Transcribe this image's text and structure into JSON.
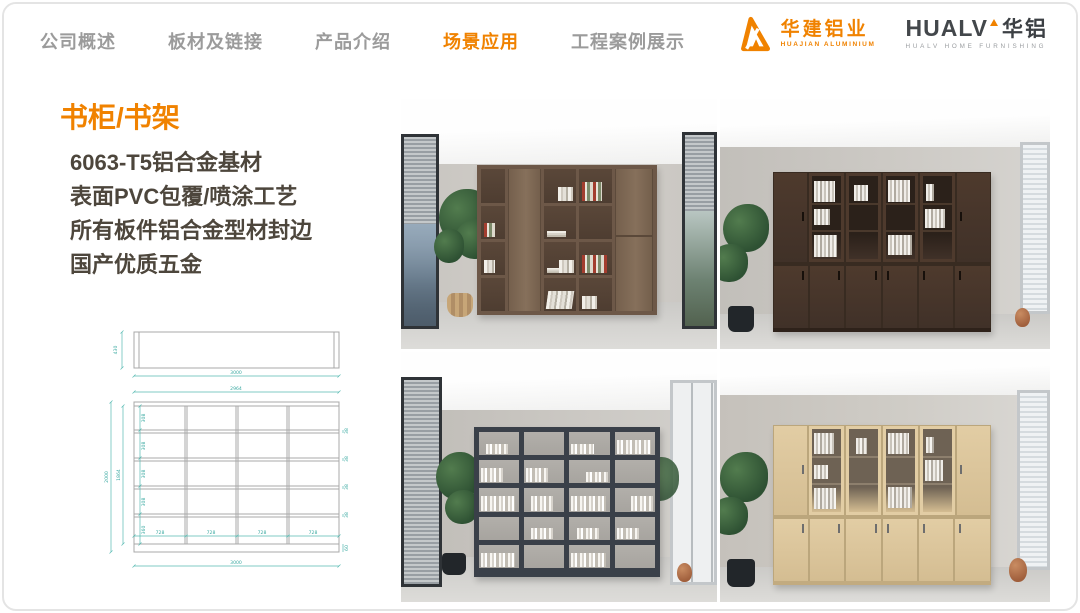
{
  "nav": {
    "items": [
      {
        "label": "公司概述",
        "active": false
      },
      {
        "label": "板材及链接",
        "active": false
      },
      {
        "label": "产品介绍",
        "active": false
      },
      {
        "label": "场景应用",
        "active": true
      },
      {
        "label": "工程案例展示",
        "active": false
      }
    ]
  },
  "brand": {
    "huajian_cn": "华建铝业",
    "huajian_en": "HUAJIAN ALUMINIUM",
    "hualv_en": "HUALV",
    "hualv_cn": "华铝",
    "hualv_sub": "HUALV HOME FURNISHING"
  },
  "content": {
    "title": "书柜/书架",
    "specs": [
      "6063-T5铝合金基材",
      "表面PVC包覆/喷涂工艺",
      "所有板件铝合金型材封边",
      "国产优质五金"
    ]
  },
  "drawing": {
    "top_view": {
      "height": "430",
      "width": "3000"
    },
    "front_view": {
      "inner_width": "2964",
      "total_width": "3000",
      "total_height": "2000",
      "inner_height": "1864",
      "rows": [
        "308",
        "308",
        "308",
        "308",
        "360"
      ],
      "cols": [
        "728",
        "728",
        "728",
        "728"
      ],
      "side": [
        "38",
        "38",
        "38",
        "38"
      ],
      "base": "60"
    }
  },
  "colors": {
    "accent": "#f08200",
    "nav_inactive": "#9b9b9b",
    "body_text": "#4d463c",
    "dim_line": "#4fb5ad",
    "walnut": "#6d5848",
    "dark_walnut": "#4e3a2d",
    "charcoal": "#3a4049",
    "oak": "#e2cda4"
  }
}
